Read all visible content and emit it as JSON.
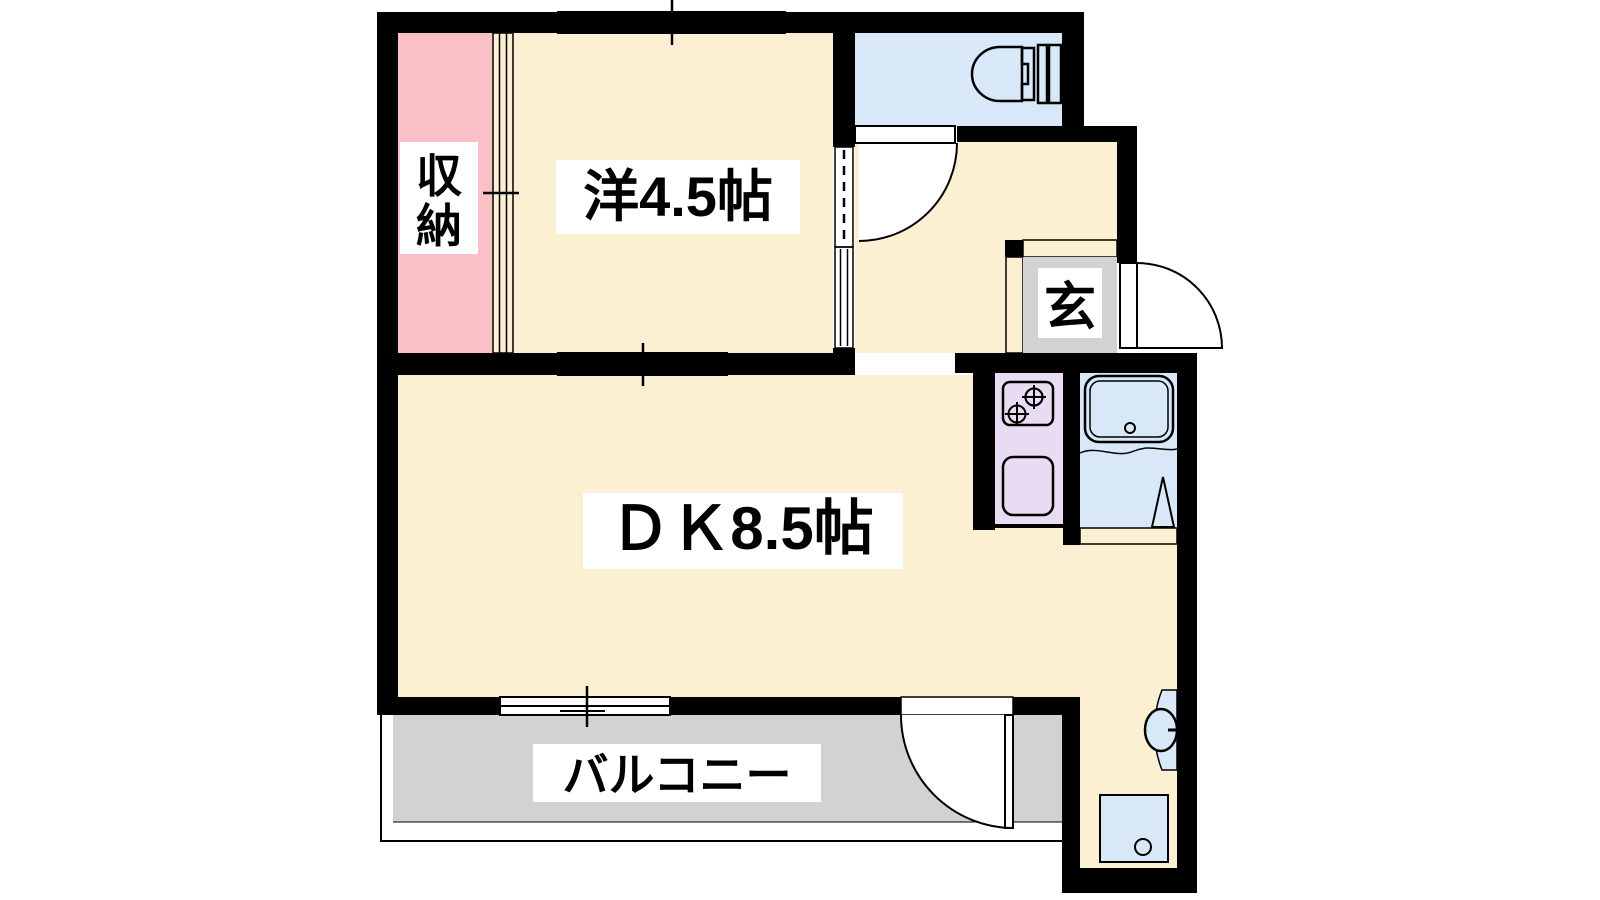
{
  "title": "apartment-floor-plan",
  "colors": {
    "wall": "#000000",
    "floor_cream": "#FCF0D2",
    "closet_pink": "#F9C1C5",
    "wet_blue": "#D9E8F8",
    "kitchen_lavender": "#E9DCF2",
    "gray": "#D2D2D2",
    "background": "#FFFFFF"
  },
  "rooms": {
    "western_room": {
      "label": "洋4.5帖"
    },
    "closet": {
      "label": "収納",
      "chars": [
        "収",
        "納"
      ]
    },
    "dining_kitchen": {
      "label": "ＤＫ8.5帖"
    },
    "entrance": {
      "label": "玄"
    },
    "balcony": {
      "label": "バルコニー"
    }
  },
  "fixtures": {
    "toilet": "toilet-icon",
    "bathtub": "bathtub-icon",
    "stove": "two-burner-stove-icon",
    "kitchen_sink": "kitchen-sink-icon",
    "washbasin": "washbasin-icon",
    "washing_machine": "washing-machine-pan-icon",
    "bath_folding_door": "folding-door-icon"
  }
}
